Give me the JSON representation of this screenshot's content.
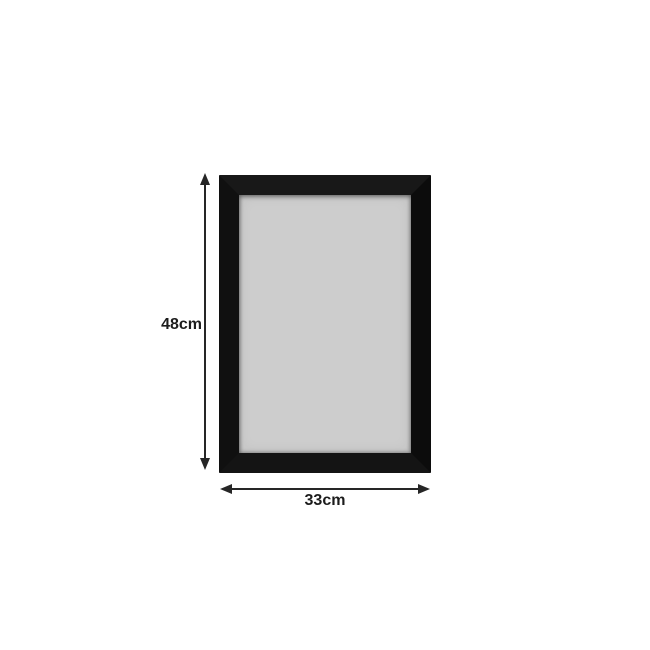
{
  "page": {
    "background_color": "#ffffff"
  },
  "frame": {
    "border_color": "#121212",
    "surface_color": "#cdcdcd"
  },
  "dimensions": {
    "height_label": "48cm",
    "width_label": "33cm",
    "arrow_color": "#262626",
    "text_color": "#1c1c1c"
  }
}
